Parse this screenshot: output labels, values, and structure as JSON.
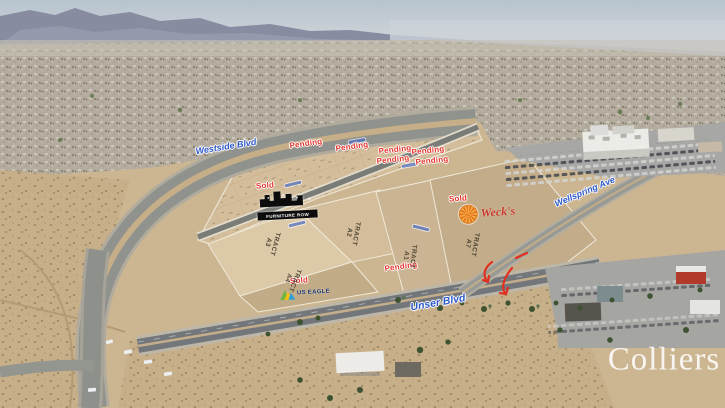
{
  "brand": {
    "watermark": "Colliers"
  },
  "streets": {
    "westside_blvd": "Westside Blvd",
    "unser_blvd": "Unser Blvd",
    "wellspring_ave": "Wellspring Ave"
  },
  "status": {
    "pending": "Pending",
    "sold": "Sold"
  },
  "tract_prefix": "TRACT",
  "tracts": [
    {
      "label": "TRACT",
      "id": "A1"
    },
    {
      "label": "TRACT",
      "id": "A2"
    },
    {
      "label": "TRACT",
      "id": "A3"
    },
    {
      "label": "TRACT",
      "id": "A4"
    },
    {
      "label": "TRACT",
      "id": "A7"
    }
  ],
  "logos": {
    "furniture_row": "FURNITURE ROW",
    "sunburst_script": "Weck's",
    "us_eagle": "US EAGLE"
  },
  "colors": {
    "status_red": "#e5352b",
    "street_blue": "#2d59c8",
    "dirt_tan": "#ccb692",
    "asphalt_gray": "#75787a",
    "watermark_white": "#ffffff"
  }
}
